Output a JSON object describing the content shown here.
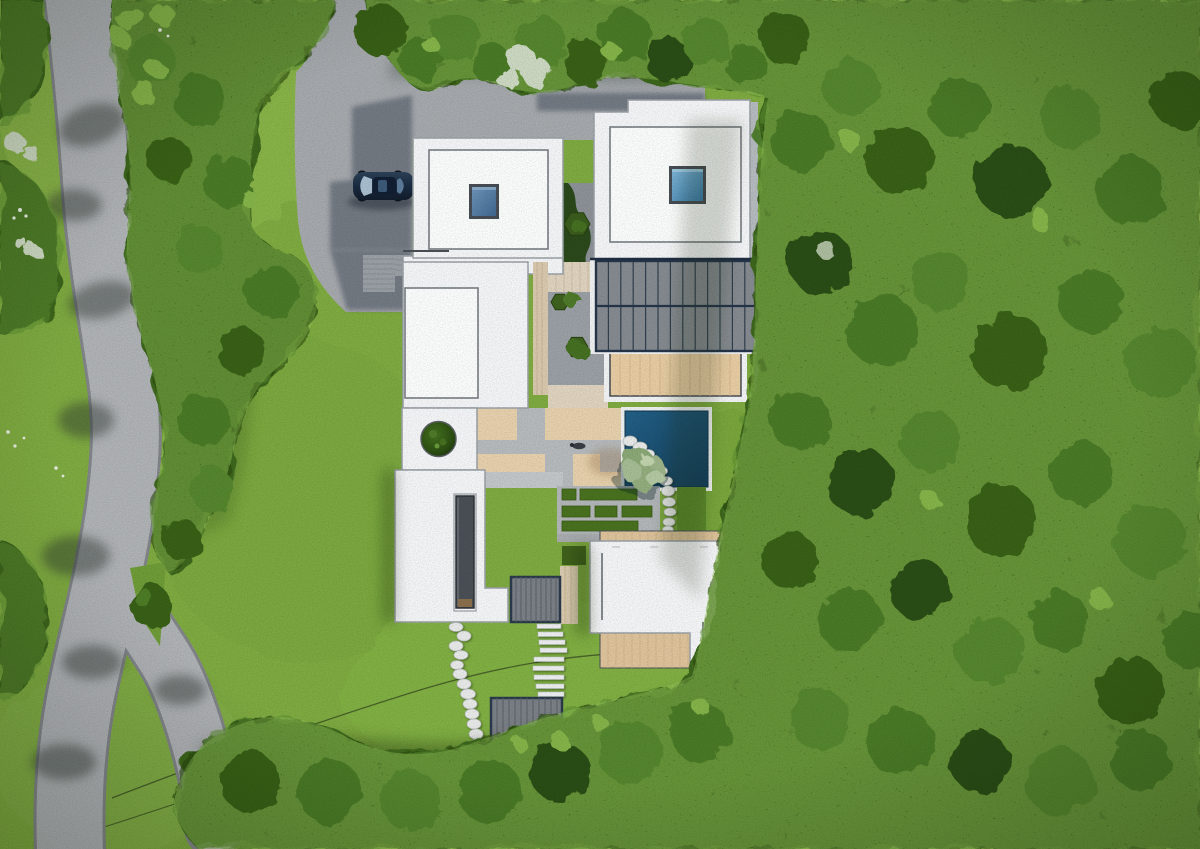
{
  "scene": {
    "title": "Aerial site plan rendering",
    "type": "top-down 3D architectural visualization",
    "setting": "modern flat-roof house in a forest clearing beside a curving forked road"
  },
  "colors": {
    "lawn": "#7fab41",
    "lawnLight": "#8fba4e",
    "lawnShade": "#5f8c30",
    "forest": "#3c661f",
    "forestDark": "#294a10",
    "forestLight": "#5d8f33",
    "forestSpeckle": "#9ecf63",
    "road": "#b0b3b6",
    "roadCasing": "#82868a",
    "driveway": "#a6aaae",
    "buildingShadow": "#5b616c",
    "roofWhite": "#f5f6f8",
    "skylightFrame": "#474d54",
    "solarPanel": "#868b91",
    "solarFrame": "#26354a",
    "terraceWood": "#e8cda3",
    "deckWood": "#dfc49c",
    "courtyardWood": "#e0d4c0",
    "patioSand": "#e7d1ad",
    "patioPath": "#b7bbbd",
    "pool": "#1b5173",
    "poolRim": "#eef1f2",
    "hedge": "#49721f",
    "planterBush": "#3a5c1d",
    "poolTree": "#9db489",
    "paleBush": "#cdd9c2",
    "car": "#1e3048",
    "carGlass": "#a9bfd0",
    "stoneWhite": "#e9ebea",
    "rampPad": "#9aa0a6",
    "gravelBlob": "#8d9298"
  },
  "site": {
    "house": {
      "white_roof_volumes": 5,
      "skylights": 2,
      "solar_panels": {
        "rows": 2,
        "columns": 13
      },
      "roof_terraces": 1,
      "linear_roof_light_slot": 1,
      "circular_tree_opening": 1
    },
    "pool": {
      "shape": "rectangular",
      "color": "deep blue",
      "white_rim": true
    },
    "landscape": {
      "stepping_stones": 13,
      "pool_side_pebbles": 11,
      "stair_treads": 9,
      "stair_decks": 2,
      "hedge_rows": 3,
      "hexagon_planters": 3,
      "hedge_trail_rows": 3,
      "flower_bush_clusters": 4
    },
    "vehicles": {
      "cars": 1,
      "car_color": "dark navy"
    },
    "circulation": {
      "main_road": "curves along the left edge and forks near the bottom",
      "driveway": "gray apron connecting the road to the house at top",
      "wires": 2
    }
  }
}
